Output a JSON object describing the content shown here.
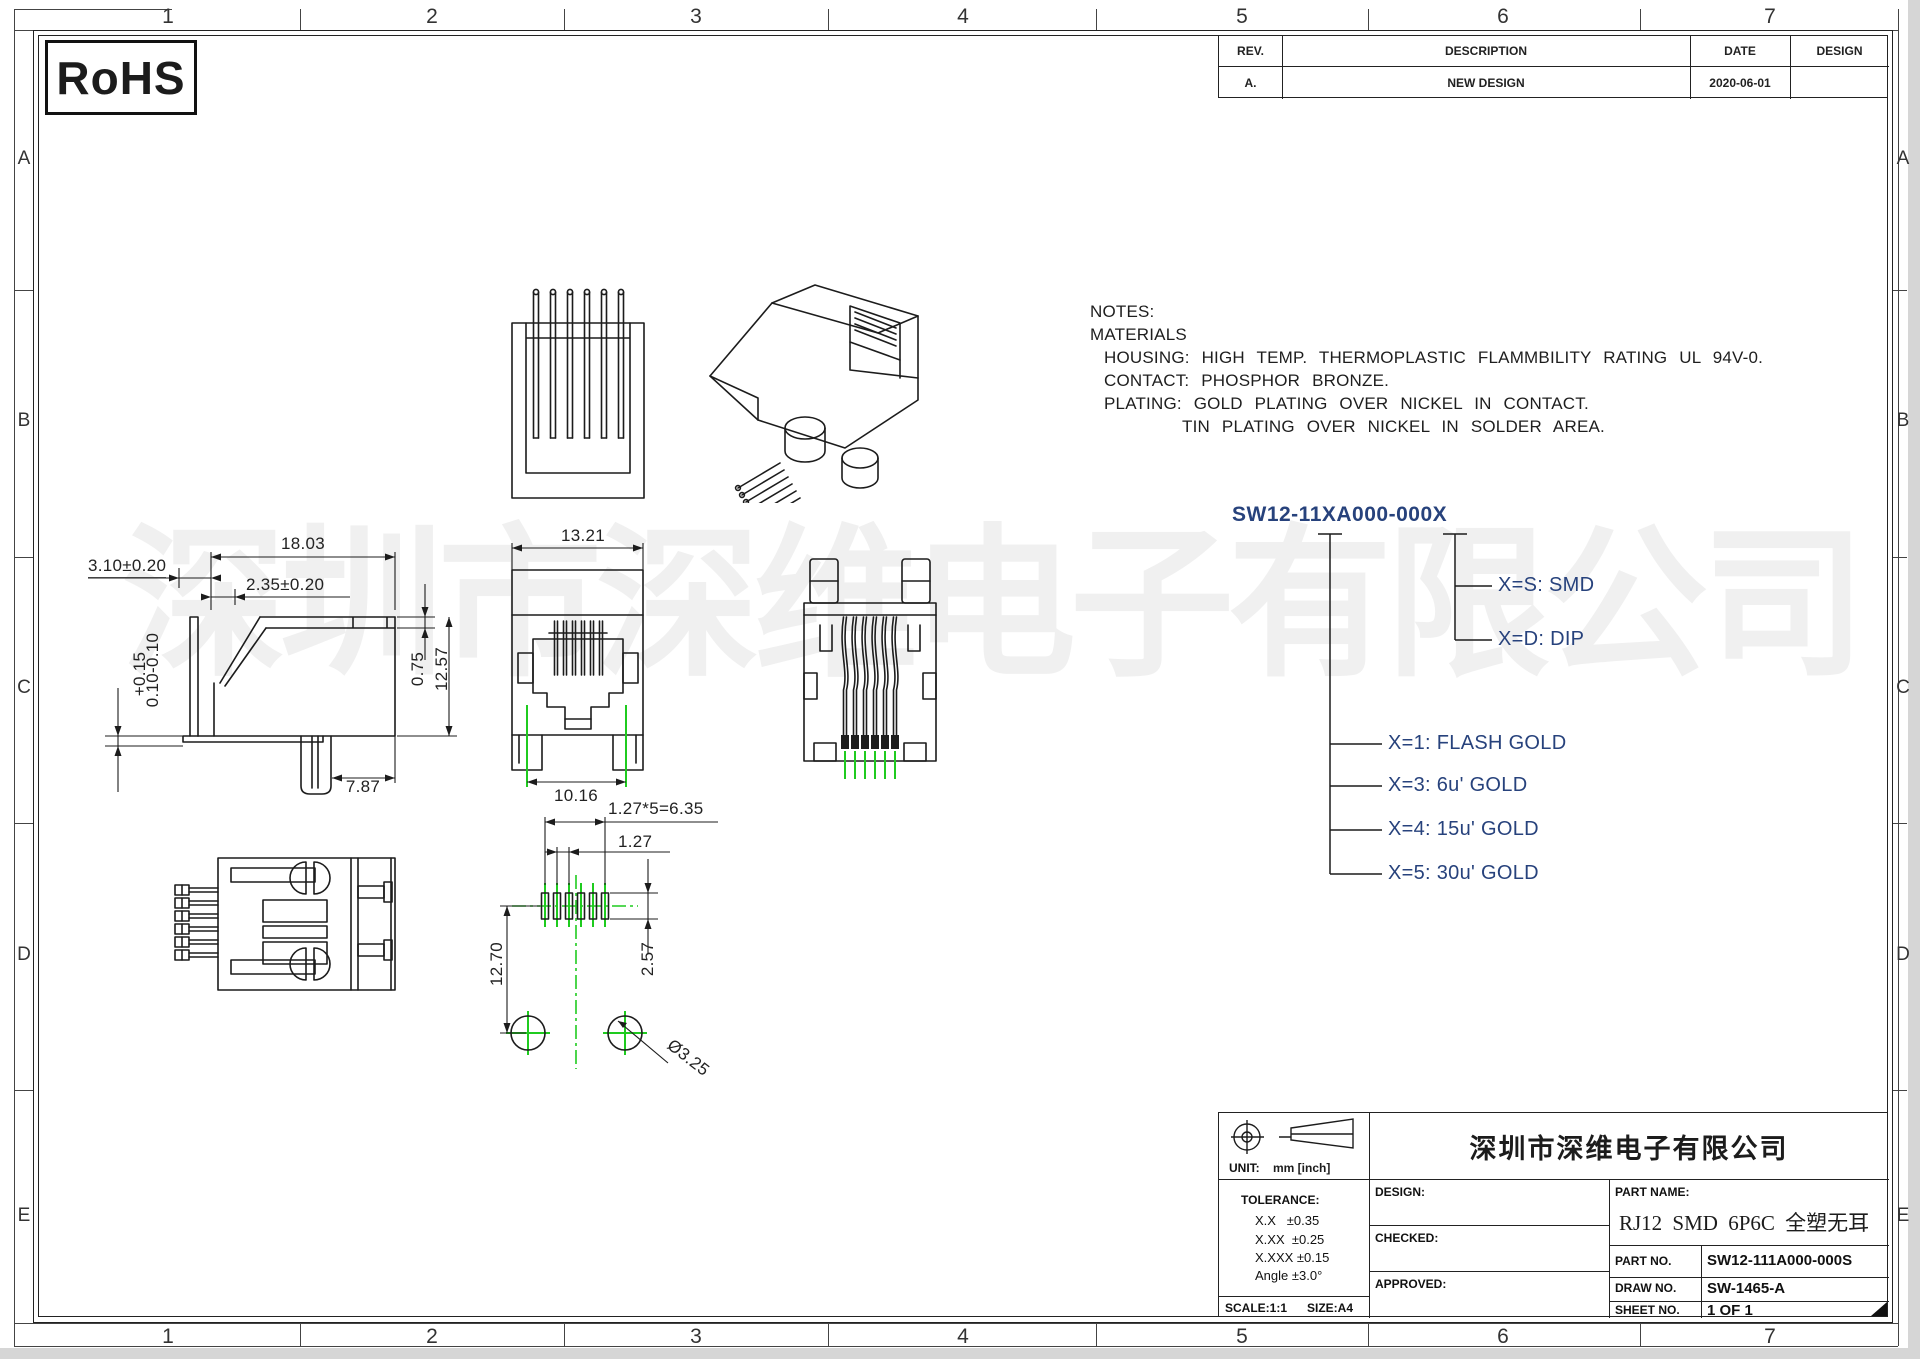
{
  "colors": {
    "line": "#1c1c1c",
    "green": "#1fcb1f",
    "tree": "#27427c",
    "watermark": "rgba(0,0,0,0.06)",
    "sheet-edge": "#d6d6d6"
  },
  "rohs": "RoHS",
  "watermark": "深圳市深维电子有限公司",
  "grid": {
    "cols": [
      "1",
      "2",
      "3",
      "4",
      "5",
      "6",
      "7"
    ],
    "rows": [
      "A",
      "B",
      "C",
      "D",
      "E"
    ]
  },
  "revision": {
    "rev_h": "REV.",
    "desc_h": "DESCRIPTION",
    "date_h": "DATE",
    "design_h": "DESIGN",
    "rev": "A.",
    "desc": "NEW DESIGN",
    "date": "2020-06-01",
    "design": ""
  },
  "notes": {
    "l1": "NOTES:",
    "l2": "MATERIALS",
    "l3": "HOUSING: HIGH TEMP. THERMOPLASTIC FLAMMBILITY RATING UL 94V-0.",
    "l4": "CONTACT: PHOSPHOR BRONZE.",
    "l5": "PLATING: GOLD PLATING OVER NICKEL IN CONTACT.",
    "l6": "TIN PLATING OVER NICKEL IN SOLDER AREA."
  },
  "part_tree": {
    "root": "SW12-11XA000-000X",
    "s": "X=S: SMD",
    "d": "X=D: DIP",
    "g1": "X=1: FLASH GOLD",
    "g3": "X=3: 6u' GOLD",
    "g4": "X=4: 15u' GOLD",
    "g5": "X=5: 30u' GOLD"
  },
  "dims": {
    "side_width": "18.03",
    "side_a": "3.10±0.20",
    "side_b": "2.35±0.20",
    "side_tol_top": "+0.15",
    "side_tol_bot": "0.10-0.10",
    "wall": "0.75",
    "height": "12.57",
    "foot": "7.87",
    "front_w": "13.21",
    "front_feet": "10.16",
    "pitch_total": "1.27*5=6.35",
    "pitch": "1.27",
    "pad": "2.57",
    "row": "12.70",
    "hole": "Ø3.25"
  },
  "title_block": {
    "company": "深圳市深维电子有限公司",
    "unit_label": "UNIT:",
    "unit_value": "mm [inch]",
    "tol_title": "TOLERANCE:",
    "tol1": "X.X   ±0.35",
    "tol2": "X.XX  ±0.25",
    "tol3": "X.XXX ±0.15",
    "tol4": "Angle ±3.0°",
    "scale": "SCALE:1:1",
    "size": "SIZE:A4",
    "design": "DESIGN:",
    "checked": "CHECKED:",
    "approved": "APPROVED:",
    "part_name_label": "PART NAME:",
    "part_name": "RJ12 SMD 6P6C 全塑无耳",
    "part_no_label": "PART NO.",
    "part_no": "SW12-111A000-000S",
    "draw_no_label": "DRAW NO.",
    "draw_no": "SW-1465-A",
    "sheet_label": "SHEET NO.",
    "sheet": "1 OF 1"
  }
}
